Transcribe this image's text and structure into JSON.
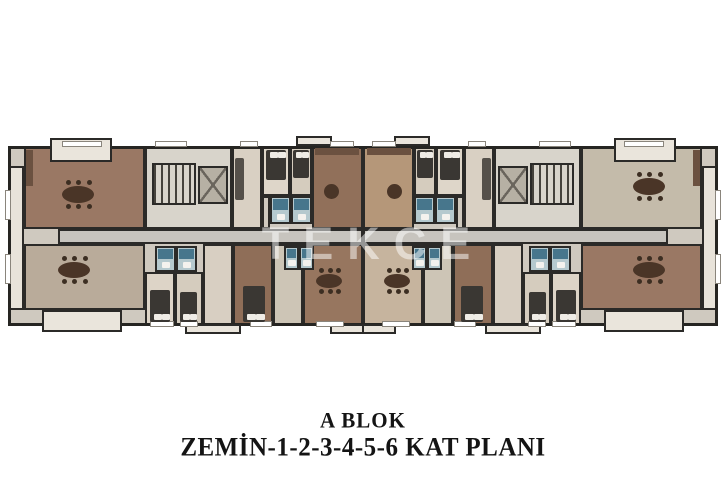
{
  "title": {
    "block": "A BLOK",
    "floors": "ZEMİN-1-2-3-4-5-6 KAT PLANI"
  },
  "watermark": "TEKCE",
  "palette": {
    "wall": "#2b2a28",
    "salon_brown": "#9a7864",
    "salon_light": "#c4bbaa",
    "bedroom_beige": "#d9d0c3",
    "bath_teal": "#47768c",
    "corridor_gray": "#c7c4be",
    "balcony_light": "#eae5dc"
  },
  "plan": {
    "rooms": [
      {
        "n": "building-base",
        "x": 8,
        "y": 146,
        "w": 710,
        "h": 180,
        "c": "#cfc9bf"
      },
      {
        "n": "edge-balcony",
        "x": 8,
        "y": 166,
        "w": 16,
        "h": 144,
        "c": "#e8e3da",
        "m": true
      },
      {
        "n": "salon-top-left",
        "x": 24,
        "y": 146,
        "w": 121,
        "h": 83,
        "c": "#9a7864"
      },
      {
        "n": "salon-bottom-left",
        "x": 24,
        "y": 244,
        "w": 121,
        "h": 66,
        "c": "#b9ab9a"
      },
      {
        "n": "salon-top-right",
        "x": 581,
        "y": 146,
        "w": 121,
        "h": 83,
        "c": "#c4bbaa"
      },
      {
        "n": "salon-bottom-right",
        "x": 581,
        "y": 244,
        "w": 121,
        "h": 66,
        "c": "#9a7864"
      },
      {
        "n": "stair-core",
        "x": 145,
        "y": 146,
        "w": 87,
        "h": 83,
        "c": "#d8d4cb",
        "m": true
      },
      {
        "n": "living-room",
        "x": 232,
        "y": 146,
        "w": 30,
        "h": 83,
        "c": "#d9d0c3",
        "m": true
      },
      {
        "n": "bedroom-a",
        "x": 262,
        "y": 146,
        "w": 28,
        "h": 50,
        "c": "#ded6c9",
        "m": true
      },
      {
        "n": "bedroom-b",
        "x": 290,
        "y": 146,
        "w": 22,
        "h": 50,
        "c": "#d5ccbe",
        "m": true
      },
      {
        "n": "hall",
        "x": 262,
        "y": 196,
        "w": 8,
        "h": 33,
        "c": "#cfc9bf",
        "m": true
      },
      {
        "n": "salon-center-top-left",
        "x": 312,
        "y": 146,
        "w": 51,
        "h": 83,
        "c": "#91705a"
      },
      {
        "n": "salon-center-top-right",
        "x": 363,
        "y": 146,
        "w": 51,
        "h": 83,
        "c": "#b59779"
      },
      {
        "n": "bedroom-c",
        "x": 145,
        "y": 272,
        "w": 30,
        "h": 54,
        "c": "#ddd4c7",
        "m": true
      },
      {
        "n": "bedroom-d",
        "x": 175,
        "y": 272,
        "w": 28,
        "h": 54,
        "c": "#d5ccbe",
        "m": true
      },
      {
        "n": "room-e",
        "x": 203,
        "y": 244,
        "w": 30,
        "h": 82,
        "c": "#d8cfc2",
        "m": true
      },
      {
        "n": "bedroom-f",
        "x": 233,
        "y": 244,
        "w": 40,
        "h": 82,
        "c": "#8f6e58",
        "m": true
      },
      {
        "n": "kitchen",
        "x": 273,
        "y": 244,
        "w": 30,
        "h": 82,
        "c": "#cdc5b6",
        "m": true
      },
      {
        "n": "salon-center-bottom-left",
        "x": 303,
        "y": 244,
        "w": 60,
        "h": 82,
        "c": "#97765f"
      },
      {
        "n": "salon-center-bottom-right",
        "x": 363,
        "y": 244,
        "w": 60,
        "h": 82,
        "c": "#c6b49e"
      },
      {
        "n": "corridor",
        "x": 58,
        "y": 229,
        "w": 305,
        "h": 15,
        "c": "#c7c4be",
        "m": true
      }
    ],
    "outline": {
      "x": 8,
      "y": 146,
      "w": 710,
      "h": 180
    },
    "balconies": [
      {
        "x": 50,
        "y": 138,
        "w": 62,
        "h": 24
      },
      {
        "x": 614,
        "y": 138,
        "w": 62,
        "h": 24
      },
      {
        "x": 42,
        "y": 310,
        "w": 80,
        "h": 22
      },
      {
        "x": 604,
        "y": 310,
        "w": 80,
        "h": 22
      },
      {
        "x": 296,
        "y": 136,
        "w": 36,
        "h": 10,
        "m": true
      },
      {
        "x": 185,
        "y": 324,
        "w": 56,
        "h": 10,
        "m": true
      },
      {
        "x": 330,
        "y": 324,
        "w": 34,
        "h": 10,
        "m": true
      }
    ],
    "stairs": [
      {
        "x": 152,
        "y": 163,
        "w": 44,
        "h": 42,
        "m": true
      }
    ],
    "elevators": [
      {
        "x": 198,
        "y": 166,
        "w": 30,
        "h": 38,
        "m": true
      }
    ],
    "baths": [
      {
        "x": 270,
        "y": 196,
        "w": 21,
        "h": 28,
        "m": true
      },
      {
        "x": 291,
        "y": 196,
        "w": 21,
        "h": 28,
        "m": true
      },
      {
        "x": 155,
        "y": 246,
        "w": 21,
        "h": 26,
        "m": true
      },
      {
        "x": 176,
        "y": 246,
        "w": 21,
        "h": 26,
        "m": true
      },
      {
        "x": 284,
        "y": 246,
        "w": 15,
        "h": 24,
        "m": true
      },
      {
        "x": 299,
        "y": 246,
        "w": 15,
        "h": 24,
        "m": true
      }
    ],
    "windows": [
      {
        "x": 62,
        "y": 141,
        "w": 40,
        "h": 6,
        "m": true
      },
      {
        "x": 155,
        "y": 141,
        "w": 32,
        "h": 6,
        "m": true
      },
      {
        "x": 240,
        "y": 141,
        "w": 18,
        "h": 6,
        "m": true
      },
      {
        "x": 330,
        "y": 141,
        "w": 24,
        "h": 6,
        "m": true
      },
      {
        "x": 150,
        "y": 321,
        "w": 24,
        "h": 6,
        "m": true
      },
      {
        "x": 180,
        "y": 321,
        "w": 18,
        "h": 6,
        "m": true
      },
      {
        "x": 250,
        "y": 321,
        "w": 22,
        "h": 6,
        "m": true
      },
      {
        "x": 316,
        "y": 321,
        "w": 28,
        "h": 6,
        "m": true
      },
      {
        "x": 5,
        "y": 190,
        "w": 6,
        "h": 30,
        "m": true
      },
      {
        "x": 5,
        "y": 254,
        "w": 6,
        "h": 30,
        "m": true
      }
    ],
    "furniture": [
      {
        "t": "bed",
        "x": 266,
        "y": 150,
        "w": 20,
        "h": 30,
        "p": "top",
        "m": true
      },
      {
        "t": "bed",
        "x": 293,
        "y": 150,
        "w": 16,
        "h": 28,
        "p": "top",
        "m": true
      },
      {
        "t": "bed",
        "x": 150,
        "y": 290,
        "w": 20,
        "h": 32,
        "p": "bottom",
        "m": true
      },
      {
        "t": "bed",
        "x": 180,
        "y": 292,
        "w": 17,
        "h": 30,
        "p": "bottom",
        "m": true
      },
      {
        "t": "bed",
        "x": 243,
        "y": 286,
        "w": 22,
        "h": 36,
        "p": "bottom",
        "m": true
      },
      {
        "t": "table",
        "x": 62,
        "y": 186,
        "w": 32,
        "h": 17
      },
      {
        "t": "table",
        "x": 633,
        "y": 178,
        "w": 32,
        "h": 17
      },
      {
        "t": "table",
        "x": 58,
        "y": 262,
        "w": 32,
        "h": 16
      },
      {
        "t": "table",
        "x": 633,
        "y": 262,
        "w": 32,
        "h": 16
      },
      {
        "t": "table",
        "x": 316,
        "y": 274,
        "w": 26,
        "h": 14,
        "m": true
      },
      {
        "t": "rtable",
        "x": 324,
        "y": 184,
        "w": 15,
        "h": 15,
        "m": true
      },
      {
        "t": "sofa",
        "x": 235,
        "y": 158,
        "w": 9,
        "h": 42,
        "m": true
      },
      {
        "t": "counter",
        "x": 315,
        "y": 148,
        "w": 44,
        "h": 7,
        "m": true
      },
      {
        "t": "counter",
        "x": 26,
        "y": 150,
        "w": 7,
        "h": 36
      },
      {
        "t": "counter",
        "x": 693,
        "y": 150,
        "w": 7,
        "h": 36
      }
    ]
  }
}
